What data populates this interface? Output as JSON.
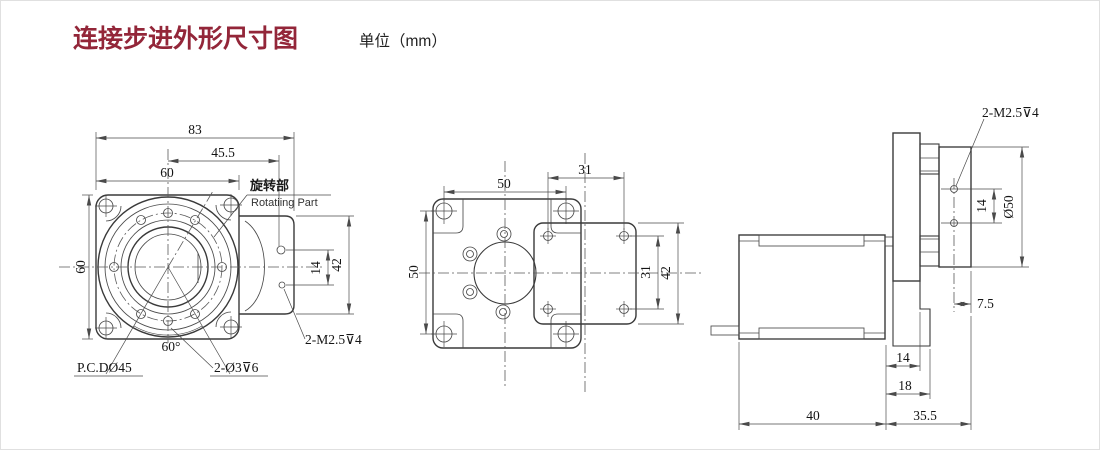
{
  "title": {
    "text": "连接步进外形尺寸图",
    "unit": "单位（mm）",
    "accent_color": "#932639"
  },
  "left": {
    "d83": "83",
    "d455": "45.5",
    "d60_top": "60",
    "d60_left": "60",
    "d14": "14",
    "d42": "42",
    "rotating_cn": "旋转部",
    "rotating_en": "Rotatiing Part",
    "pcd": "P.C.DØ45",
    "angle": "60°",
    "holes": "2-Ø3⊽6",
    "tap": "2-M2.5⊽4"
  },
  "middle": {
    "d50_top": "50",
    "d31_top": "31",
    "d50_left": "50",
    "d31_right": "31",
    "d42_right": "42"
  },
  "right": {
    "tap": "2-M2.5⊽4",
    "d14_span": "14",
    "d50": "Ø50",
    "d75": "7.5",
    "d14": "14",
    "d18": "18",
    "d40": "40",
    "d355": "35.5"
  }
}
